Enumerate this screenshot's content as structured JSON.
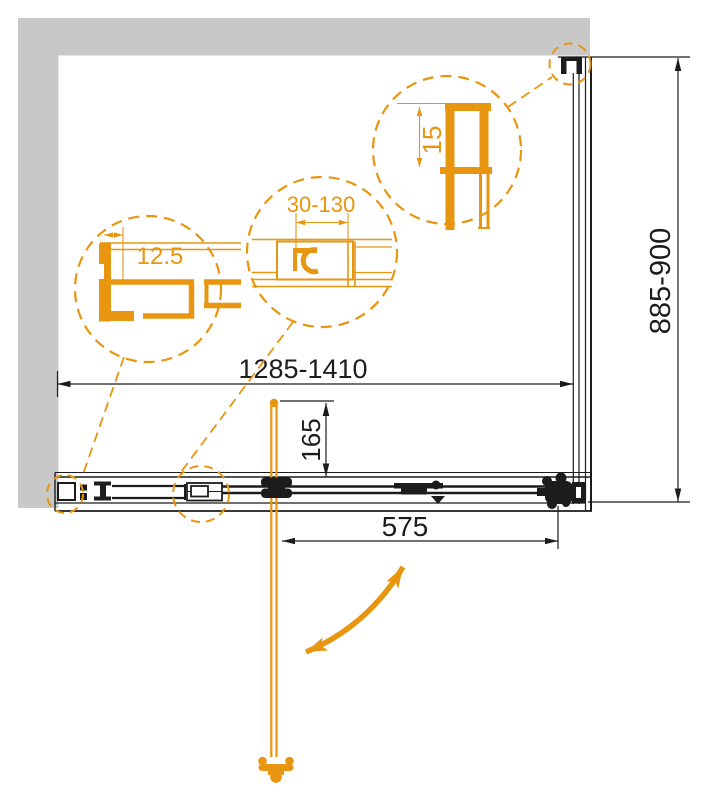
{
  "drawing": {
    "title": "Shower enclosure plan view technical drawing",
    "colors": {
      "accent_orange": "#E8950F",
      "wall_gray": "#C8C8C8",
      "line_black": "#1C1C1C",
      "background": "#FFFFFF"
    },
    "dimensions": {
      "overall_width": "1285-1410",
      "side_panel_depth": "885-900",
      "handle_offset": "165",
      "door_opening": "575"
    },
    "details": [
      {
        "name": "wall-profile-detail",
        "label": "12.5"
      },
      {
        "name": "adjustment-profile-detail",
        "label": "30-130"
      },
      {
        "name": "top-rail-profile-detail",
        "label": "15"
      }
    ],
    "icons": [
      "door-swing-arrow",
      "door-handle",
      "wall-mount-bracket"
    ]
  }
}
